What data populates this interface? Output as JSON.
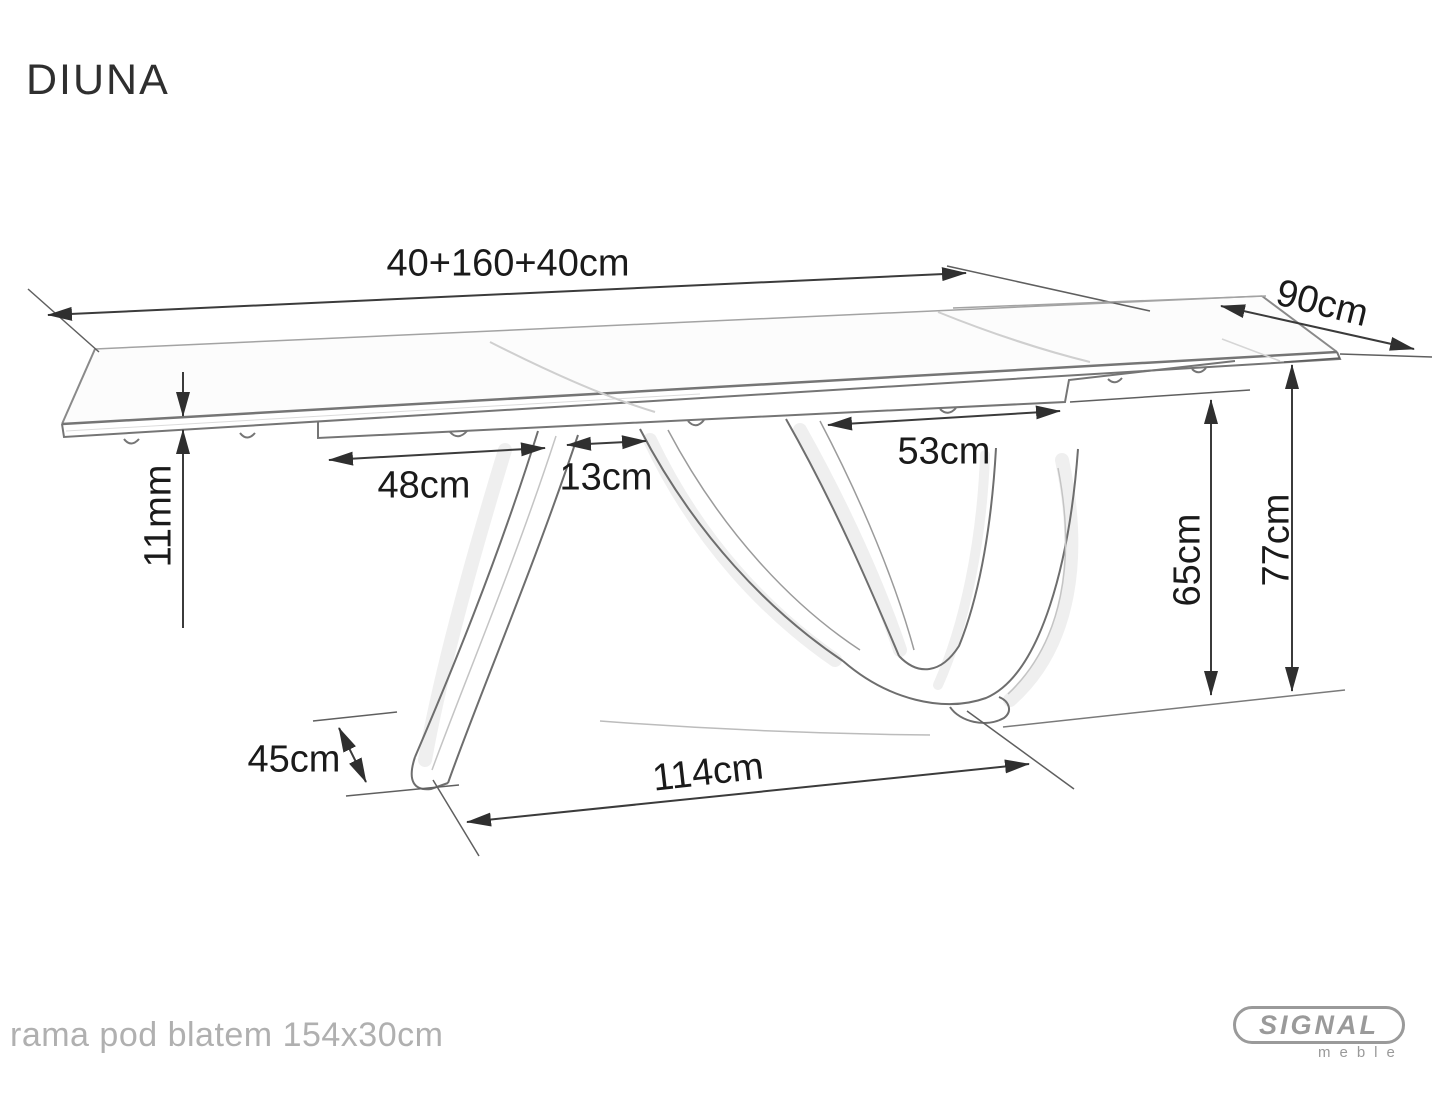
{
  "page": {
    "title": "DIUNA"
  },
  "product": {
    "name": "DIUNA",
    "type": "extendable dining table technical drawing"
  },
  "dimensions": {
    "length": "40+160+40cm",
    "width": "90cm",
    "top_thickness": "11mm",
    "left_span": "48cm",
    "center_gap": "13cm",
    "right_span": "53cm",
    "underframe_height": "65cm",
    "total_height": "77cm",
    "foot_depth": "45cm",
    "base_span": "114cm"
  },
  "footnote": "rama pod blatem 154x30cm",
  "branding": {
    "name": "SIGNAL",
    "subtitle": "meble",
    "color": "#9a9a9a"
  },
  "drawing_style": {
    "background": "#ffffff",
    "line_color": "#6e6e6e",
    "dimension_line_color": "#3b3b3b",
    "label_color": "#1a1a1a",
    "note_color": "#b0b0b0",
    "light_line_color": "#c4c4c4"
  }
}
